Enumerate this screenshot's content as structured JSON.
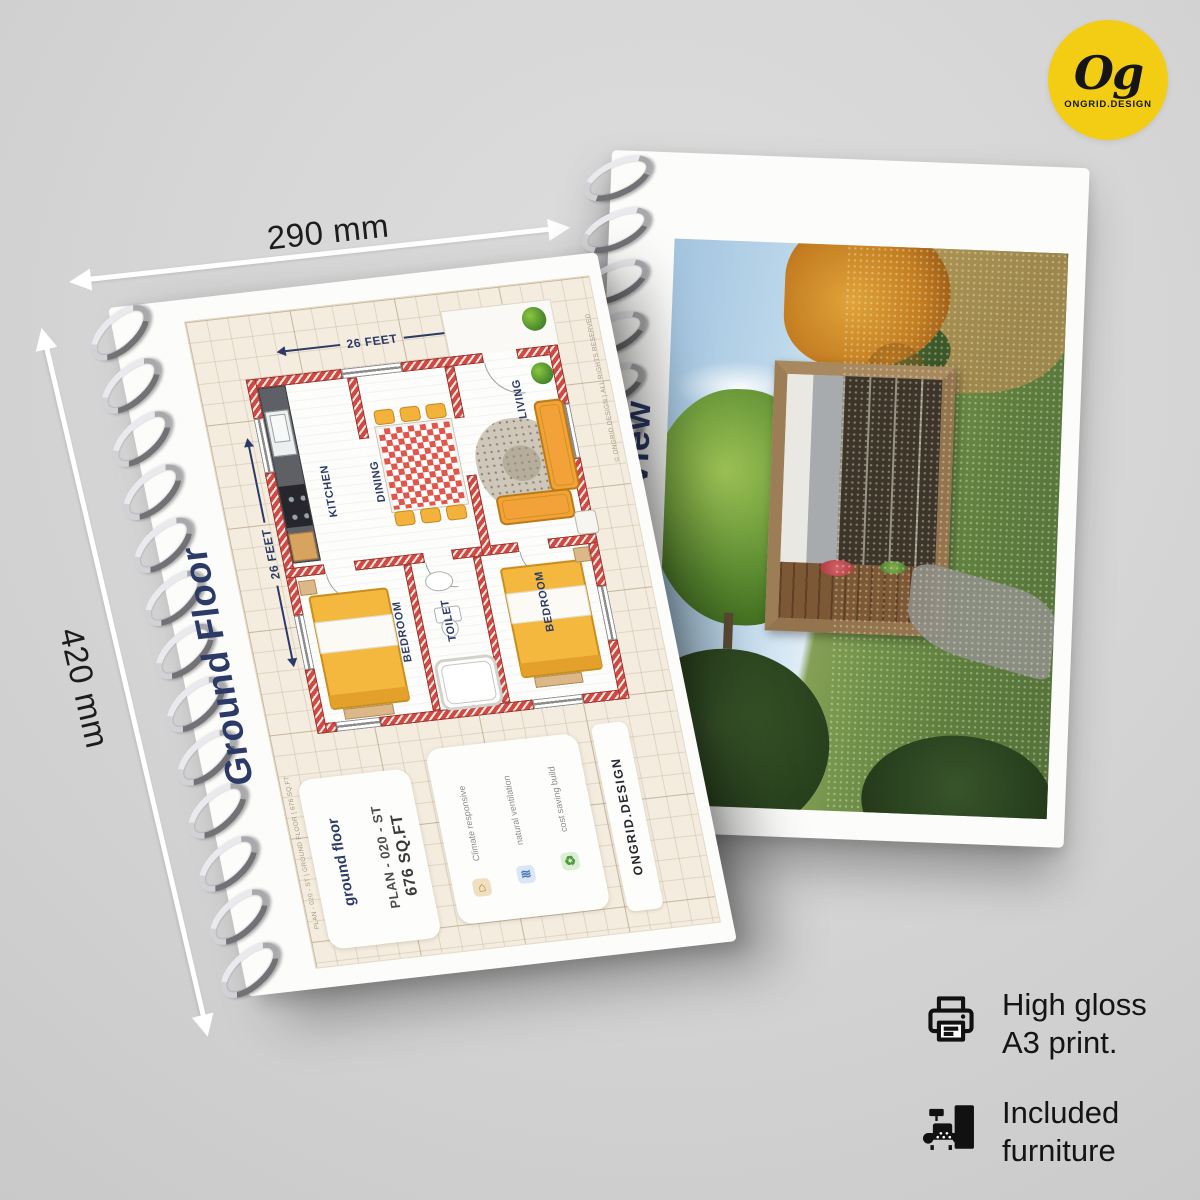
{
  "brand": {
    "logo_text": "Og",
    "logo_subtext": "ONGRID.DESIGN"
  },
  "size_labels": {
    "width": "290 mm",
    "height": "420 mm"
  },
  "left_booklet": {
    "page_title": "Ground Floor",
    "plan": {
      "dim_top": "26 FEET",
      "dim_left": "26 FEET",
      "rooms": {
        "kitchen": "KITCHEN",
        "dining": "DINING",
        "living": "LIVING",
        "bedroom_left": "BEDROOM",
        "toilet": "TOILET",
        "bedroom_right": "BEDROOM"
      }
    },
    "info_card": {
      "name": "ground floor",
      "plan_code": "PLAN - 020 - ST",
      "area": "676 SQ.FT"
    },
    "features": [
      {
        "icon": "climate-icon",
        "label": "Climate responsive"
      },
      {
        "icon": "ventilation-icon",
        "label": "natural ventilation"
      },
      {
        "icon": "eco-build-icon",
        "label": "cost saving build"
      }
    ],
    "brand_strip": "ONGRID.DESIGN",
    "fine_print_top": "© ONGRID.DESIGN | ALL RIGHTS RESERVED",
    "fine_print_bottom": "PLAN - 020 - ST | GROUND FLOOR | 676 SQ.FT"
  },
  "right_booklet": {
    "page_title": "3D View"
  },
  "callouts": [
    {
      "icon": "printer-icon",
      "line1": "High gloss",
      "line2": "A3 print."
    },
    {
      "icon": "furniture-icon",
      "line1": "Included",
      "line2": "furniture"
    }
  ],
  "colors": {
    "accent_yellow": "#F2CD13",
    "navy": "#2C3A67",
    "wall_red": "#CE4A42",
    "furniture_orange": "#F2A93B",
    "paper_cream": "#F3ECDF"
  }
}
